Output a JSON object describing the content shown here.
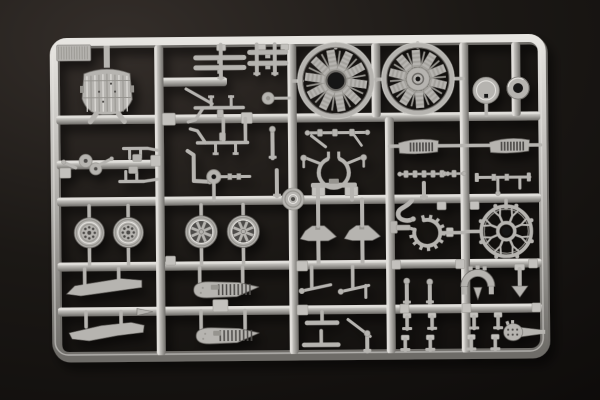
{
  "scene": {
    "subject": "photo of an injection-molded model aircraft kit sprue (gray styrene parts runner) on a dark background",
    "palette": {
      "bg_center": "#342e2a",
      "bg_mid": "#1b1815",
      "bg_edge": "#0c0a09",
      "base": "#b6b4b0",
      "light": "#e7e5e1",
      "mid": "#96948f",
      "dark": "#6e6c68",
      "line": "#4e4c48",
      "hole": "#161312",
      "tab": "#c3c1bd"
    },
    "frame": {
      "x": 55,
      "y": 40,
      "w": 488,
      "h": 314,
      "rx": 13,
      "bar": 9,
      "tilt": -0.5
    },
    "runners": {
      "h": [
        [
          118,
          57,
          541
        ],
        [
          200,
          57,
          541
        ],
        [
          265,
          57,
          541
        ],
        [
          310,
          57,
          541
        ],
        [
          163,
          57,
          160
        ],
        [
          81,
          160,
          228
        ]
      ],
      "v": [
        [
          160,
          44,
          354
        ],
        [
          293,
          44,
          354
        ],
        [
          390,
          118,
          354
        ],
        [
          465,
          44,
          354
        ],
        [
          377,
          44,
          118
        ],
        [
          517,
          44,
          118
        ]
      ]
    },
    "gate_tabs": [
      [
        163,
        112,
        13,
        12
      ],
      [
        242,
        112,
        11,
        11
      ],
      [
        312,
        187,
        13,
        9
      ],
      [
        345,
        187,
        13,
        9
      ],
      [
        296,
        261,
        11,
        10
      ],
      [
        391,
        261,
        9,
        9
      ],
      [
        455,
        261,
        9,
        9
      ],
      [
        528,
        261,
        9,
        9
      ],
      [
        296,
        305,
        11,
        10
      ],
      [
        399,
        305,
        9,
        9
      ],
      [
        461,
        305,
        9,
        9
      ],
      [
        531,
        305,
        9,
        9
      ],
      [
        218,
        44,
        9,
        6
      ],
      [
        259,
        44,
        8,
        6
      ],
      [
        282,
        44,
        8,
        6
      ],
      [
        165,
        255,
        10,
        9
      ],
      [
        437,
        203,
        9,
        8
      ],
      [
        470,
        203,
        9,
        8
      ],
      [
        446,
        229,
        7,
        9
      ],
      [
        60,
        166,
        11,
        10
      ],
      [
        151,
        154,
        10,
        11
      ],
      [
        212,
        299,
        15,
        12
      ]
    ],
    "parts": [
      {
        "name": "sprue-letter-tab",
        "type": "ribtab",
        "x": 58,
        "y": 43,
        "w": 34,
        "h": 16
      },
      {
        "name": "floor-panel",
        "type": "panel"
      },
      {
        "name": "pulley-assembly",
        "type": "twin"
      },
      {
        "name": "fitting-upper",
        "type": "gun2",
        "x": 122,
        "y": 147,
        "dir": -1
      },
      {
        "name": "fitting-lower",
        "type": "gun2",
        "x": 118,
        "y": 180,
        "dir": 1
      },
      {
        "name": "strip-part-a",
        "type": "ladder",
        "strips": [
          [
            196,
            57,
            50
          ],
          [
            196,
            67,
            50
          ]
        ],
        "posts": [
          [
            222,
            44,
            78
          ]
        ]
      },
      {
        "name": "strip-part-b",
        "type": "ladder",
        "strips": [
          [
            250,
            52,
            38
          ],
          [
            250,
            63,
            38
          ]
        ],
        "posts": [
          [
            258,
            44,
            74
          ],
          [
            276,
            44,
            74
          ]
        ]
      },
      {
        "name": "small-disc",
        "type": "smalldisc",
        "cx": 269,
        "cy": 98
      },
      {
        "name": "control-rod",
        "type": "rod",
        "x1": 187,
        "y1": 88,
        "x2": 213,
        "y2": 103,
        "w": 3
      },
      {
        "name": "machine-gun-a",
        "type": "gun",
        "x1": 196,
        "x2": 244,
        "y": 107,
        "pegs": [
          212,
          232
        ],
        "dir": -1,
        "mag": [
          218,
          109
        ]
      },
      {
        "name": "machine-gun-b",
        "type": "gun",
        "x1": 198,
        "x2": 248,
        "y": 142,
        "pegs": [
          216,
          236
        ],
        "dir": 1,
        "mag": [
          220,
          132
        ],
        "posts": [
          [
            224,
            118,
            140
          ],
          [
            246,
            118,
            140
          ]
        ]
      },
      {
        "name": "bent-lever",
        "type": "bentl"
      },
      {
        "name": "roller-wheel",
        "type": "roller"
      },
      {
        "name": "stick-a",
        "type": "stick",
        "x": 273,
        "y1": 128,
        "y2": 158,
        "knob": true
      },
      {
        "name": "stick-b",
        "type": "stick",
        "x": 277,
        "y1": 170,
        "y2": 196,
        "knob": false
      },
      {
        "name": "rocker-linkage",
        "type": "linkage"
      },
      {
        "name": "engine-mount-frame",
        "type": "mount"
      },
      {
        "name": "hub-disc",
        "type": "bossdisc",
        "cx": 293,
        "cy": 199,
        "r": 11
      },
      {
        "name": "bracket-lump-a",
        "type": "lump",
        "cx": 318,
        "cy": 233
      },
      {
        "name": "bracket-lump-b",
        "type": "lump",
        "cx": 362,
        "cy": 233
      },
      {
        "name": "ribbed-plate-a",
        "type": "banded",
        "x": 399,
        "y": 139,
        "w": 40,
        "h": 16,
        "stubs": [
          [
            390,
            399
          ],
          [
            439,
            465
          ]
        ]
      },
      {
        "name": "bead-chain-a",
        "type": "beadrod",
        "x1": 400,
        "x2": 445,
        "y": 175
      },
      {
        "name": "stub-post",
        "type": "stick",
        "x": 424,
        "y1": 184,
        "y2": 199,
        "knob": false
      },
      {
        "name": "curved-pipe",
        "type": "hook"
      },
      {
        "name": "toothed-ring",
        "type": "cog",
        "cx": 427,
        "cy": 234,
        "r": 13,
        "hstems": [
          [
            440,
            463,
            234
          ]
        ]
      },
      {
        "name": "angle-bracket",
        "type": "lpart"
      },
      {
        "name": "cowl-disc",
        "type": "dischole",
        "cx": 487,
        "cy": 92,
        "r": 13
      },
      {
        "name": "cowl-ring",
        "type": "ringpart",
        "cx": 519,
        "cy": 90,
        "r": 11,
        "ri": 5
      },
      {
        "name": "ribbed-plate-b",
        "type": "banded",
        "x": 490,
        "y": 139,
        "w": 40,
        "h": 16,
        "stubs": [
          [
            465,
            490
          ],
          [
            530,
            541
          ]
        ]
      },
      {
        "name": "bead-chain-b",
        "type": "beadrod",
        "x1": 448,
        "x2": 464,
        "y": 175
      },
      {
        "name": "axle-assembly",
        "type": "rodasm"
      },
      {
        "name": "pushrod-ring",
        "type": "spoke",
        "cx": 506,
        "cy": 233,
        "r": 25,
        "stems": [
          [
            506,
            202,
            210
          ]
        ],
        "hstems": [
          [
            466,
            481,
            233
          ]
        ]
      },
      {
        "name": "radial-engine-front",
        "type": "engine",
        "cx": 337,
        "cy": 81,
        "r": 36,
        "hub": "hole",
        "stems": [
          [
            337,
            44,
            48
          ]
        ],
        "hstems": [
          [
            294,
            303,
            81
          ],
          [
            372,
            377,
            81
          ]
        ]
      },
      {
        "name": "radial-engine-rear",
        "type": "engine",
        "cx": 419,
        "cy": 80,
        "r": 34,
        "hub": "disc",
        "stems": [
          [
            419,
            44,
            48
          ]
        ],
        "hstems": [
          [
            377,
            386,
            80
          ],
          [
            452,
            464,
            80
          ]
        ]
      },
      {
        "name": "wheel-a",
        "type": "wheel",
        "cx": 89,
        "cy": 231,
        "r": 15,
        "hub": "holes"
      },
      {
        "name": "wheel-b",
        "type": "wheel",
        "cx": 128,
        "cy": 231,
        "r": 15,
        "hub": "holes"
      },
      {
        "name": "wheel-c",
        "type": "wheel",
        "cx": 201,
        "cy": 231,
        "r": 16,
        "hub": "fan"
      },
      {
        "name": "wheel-d",
        "type": "wheel",
        "cx": 243,
        "cy": 231,
        "r": 16,
        "hub": "fan"
      },
      {
        "name": "propeller-blade-a",
        "type": "poly",
        "pts": [
          [
            66,
            292
          ],
          [
            74,
            284
          ],
          [
            120,
            277
          ],
          [
            141,
            279
          ],
          [
            141,
            286
          ],
          [
            118,
            289
          ],
          [
            80,
            294
          ]
        ],
        "stems": [
          [
            84,
            267,
            283
          ],
          [
            118,
            267,
            280
          ]
        ]
      },
      {
        "name": "propeller-blade-b",
        "type": "poly",
        "pts": [
          [
            68,
            331
          ],
          [
            100,
            324
          ],
          [
            130,
            321
          ],
          [
            143,
            324
          ],
          [
            142,
            331
          ],
          [
            116,
            334
          ],
          [
            88,
            339
          ],
          [
            71,
            337
          ]
        ],
        "stems": [
          [
            85,
            310,
            325
          ],
          [
            120,
            310,
            322
          ]
        ]
      },
      {
        "name": "cone-tip",
        "type": "poly",
        "pts": [
          [
            136,
            307
          ],
          [
            152,
            310.5
          ],
          [
            136,
            314
          ]
        ]
      },
      {
        "name": "float-a",
        "type": "float",
        "x": 186,
        "y": 281,
        "w": 76,
        "h": 16,
        "stems": [
          [
            199,
            267,
            282
          ],
          [
            242,
            267,
            282
          ]
        ]
      },
      {
        "name": "float-b",
        "type": "float",
        "x": 188,
        "y": 327,
        "w": 74,
        "h": 16,
        "stems": [
          [
            200,
            310,
            328
          ],
          [
            244,
            310,
            328
          ]
        ]
      },
      {
        "name": "lever-c",
        "type": "rod",
        "x1": 301,
        "y1": 291,
        "x2": 330,
        "y2": 285,
        "w": 3,
        "knob": [
          301,
          291,
          2.8
        ],
        "stems": [
          [
            311,
            267,
            287
          ]
        ]
      },
      {
        "name": "lever-d",
        "type": "rod",
        "x1": 340,
        "y1": 292,
        "x2": 368,
        "y2": 286,
        "w": 3,
        "knob": [
          340,
          292,
          2.8
        ],
        "seg": [
          365,
          286,
          365,
          298
        ],
        "stems": [
          [
            352,
            267,
            288
          ]
        ]
      },
      {
        "name": "shoe-bar-a",
        "type": "tbar",
        "cx": 321,
        "cy": 323,
        "w": 32,
        "post": [
          321,
          312,
          321
        ]
      },
      {
        "name": "rod-diagonal",
        "type": "rod",
        "x1": 347,
        "y1": 320,
        "x2": 369,
        "y2": 337,
        "w": 3
      },
      {
        "name": "shoe-bar-b",
        "type": "tbar",
        "cx": 320,
        "cy": 345,
        "w": 36,
        "post": [
          320,
          331,
          345
        ]
      },
      {
        "name": "stick-c",
        "type": "stick",
        "x": 366,
        "y1": 333,
        "y2": 352,
        "knob": true
      },
      {
        "name": "knob-post-a",
        "type": "stick",
        "x": 406,
        "y1": 281,
        "y2": 304,
        "knob": true
      },
      {
        "name": "knob-post-b",
        "type": "stick",
        "x": 429,
        "y1": 282,
        "y2": 304,
        "knob": true
      },
      {
        "name": "t-post-a",
        "type": "tpost",
        "cx": 406,
        "y1": 314,
        "y2": 330
      },
      {
        "name": "t-post-b",
        "type": "tpost",
        "cx": 431,
        "y1": 314,
        "y2": 330
      },
      {
        "name": "t-post-c",
        "type": "tpost",
        "cx": 404,
        "y1": 336,
        "y2": 351
      },
      {
        "name": "t-post-d",
        "type": "tpost",
        "cx": 429,
        "y1": 336,
        "y2": 351
      },
      {
        "name": "t-post-e",
        "type": "tpost",
        "cx": 473,
        "y1": 314,
        "y2": 330
      },
      {
        "name": "t-post-f",
        "type": "tpost",
        "cx": 497,
        "y1": 314,
        "y2": 330
      },
      {
        "name": "t-post-g",
        "type": "tpost",
        "cx": 470,
        "y1": 336,
        "y2": 351
      },
      {
        "name": "t-post-h",
        "type": "tpost",
        "cx": 494,
        "y1": 336,
        "y2": 351
      },
      {
        "name": "exhaust-arc",
        "type": "arc",
        "cx": 477,
        "cy": 288
      },
      {
        "name": "dart-post",
        "type": "arrowpost",
        "cx": 519
      },
      {
        "name": "grenade-part",
        "type": "teardrop",
        "cx": 512,
        "cy": 334
      }
    ]
  }
}
